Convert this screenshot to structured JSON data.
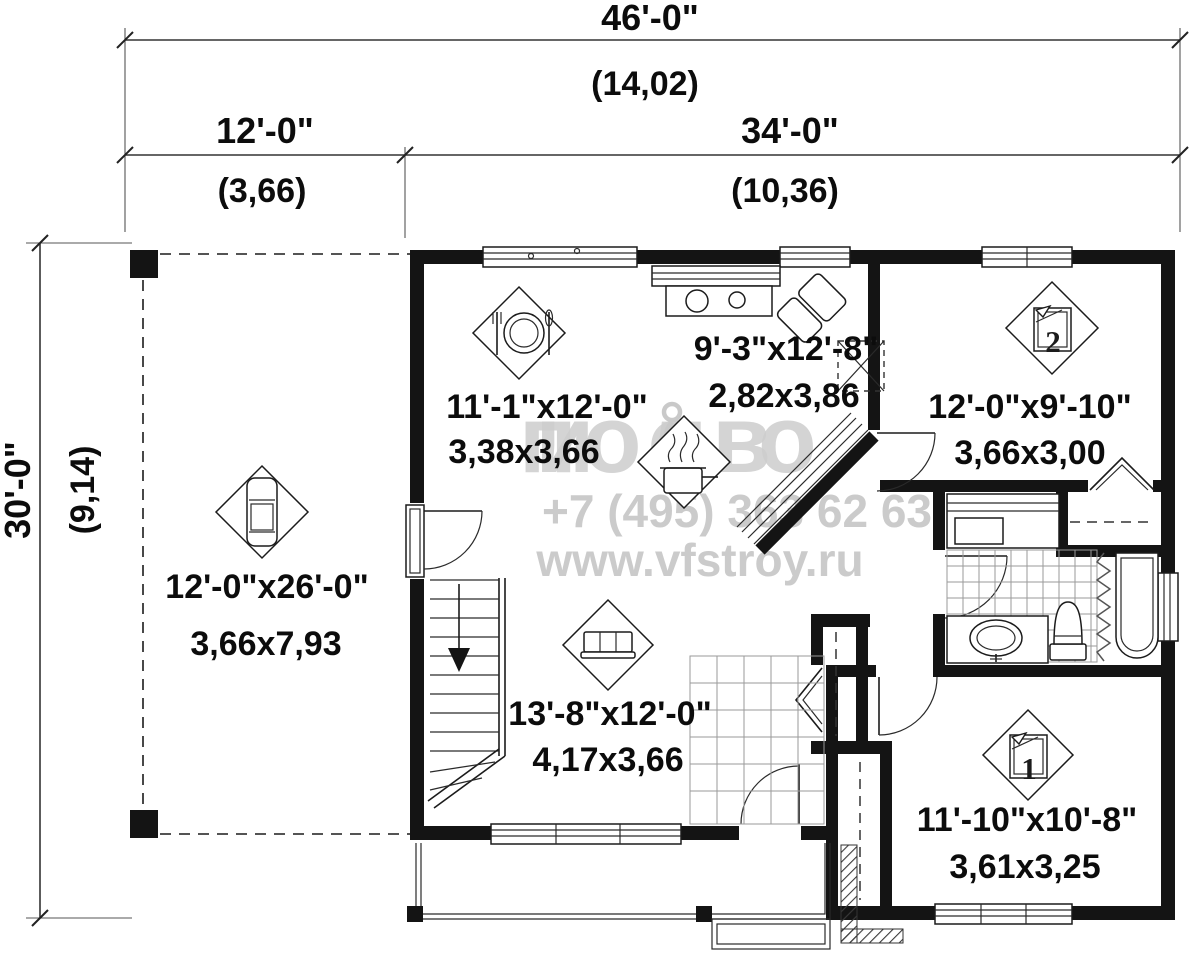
{
  "dimensions": {
    "top_total_ft": "46'-0\"",
    "top_total_m": "(14,02)",
    "top_left_ft": "12'-0\"",
    "top_left_m": "(3,66)",
    "top_right_ft": "34'-0\"",
    "top_right_m": "(10,36)",
    "side_total_ft": "30'-0\"",
    "side_total_m": "(9,14)"
  },
  "rooms": {
    "dining": {
      "size_ft": "11'-1\"x12'-0\"",
      "size_m": "3,38x3,66"
    },
    "kitchen": {
      "size_ft": "9'-3\"x12'-8\"",
      "size_m": "2,82x3,86"
    },
    "bedroom2": {
      "size_ft": "12'-0\"x9'-10\"",
      "size_m": "3,66x3,00",
      "number": "2"
    },
    "carport": {
      "size_ft": "12'-0\"x26'-0\"",
      "size_m": "3,66x7,93"
    },
    "living": {
      "size_ft": "13'-8\"x12'-0\"",
      "size_m": "4,17x3,66"
    },
    "bedroom1": {
      "size_ft": "11'-10\"x10'-8\"",
      "size_m": "3,61x3,25",
      "number": "1"
    }
  },
  "watermark": {
    "logo_left": "поов",
    "logo_right": "ило",
    "phone": "+7 (495) 363 62 63",
    "website": "www.vfstroy.ru"
  },
  "icons": {
    "dining": "plate-cutlery-icon",
    "kitchen": "cooking-pot-icon",
    "carport": "car-icon",
    "living": "sofa-icon",
    "bedroom1": "bed-icon",
    "bedroom2": "bed-icon"
  },
  "colors": {
    "walls": "#141414",
    "background": "#ffffff",
    "watermark": "#cccccc",
    "tile_grid": "#9a9a9a"
  }
}
